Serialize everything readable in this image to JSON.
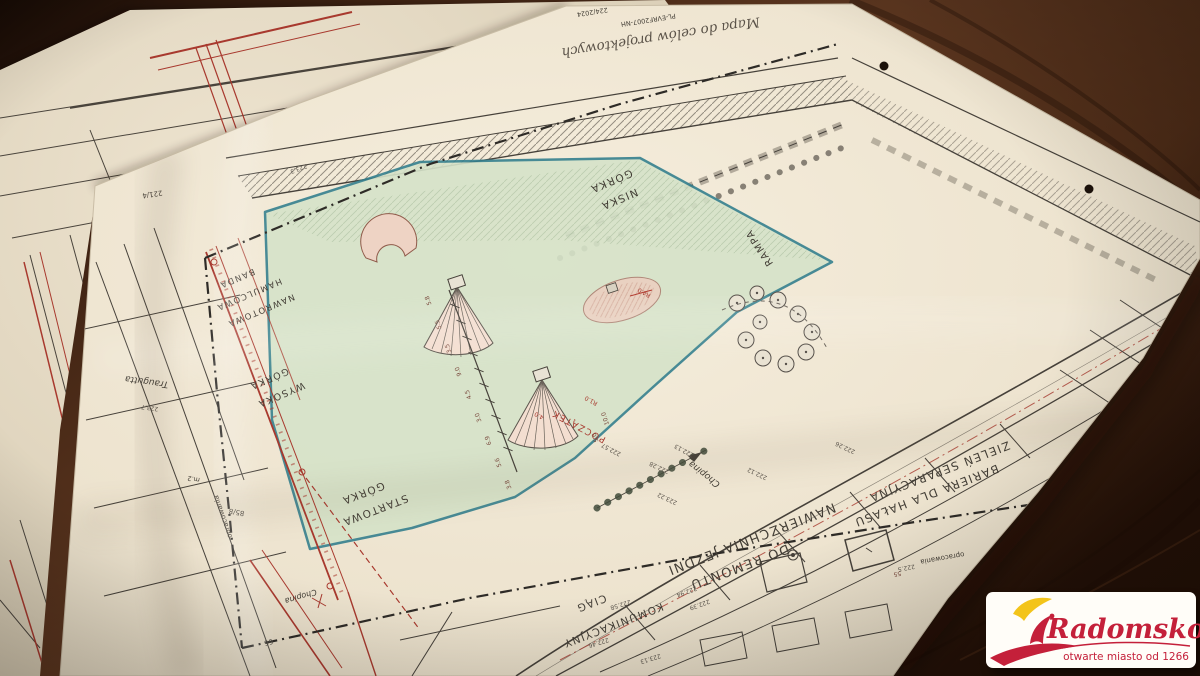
{
  "scene": {
    "description": "Photograph of technical site plans (Polish survey map for a bike/pumptrack project) lying on a dark wooden table, with the Radomsko city logo card in the bottom-right corner",
    "colors": {
      "wood": "#4e2d17",
      "paper": "#ece2cd",
      "ink": "#46413a",
      "red_lines": "#a8392e",
      "teal_outline": "#35808e",
      "site_green": "#d6e3c9",
      "ramp_pink": "#eccfc0"
    }
  },
  "plan": {
    "title": "Mapa do celów projektowych",
    "note": "PL-EVRF2007-NH",
    "reg_no": "224/2024",
    "features": {
      "gorka_niska": [
        "GÓRKA",
        "NISKA"
      ],
      "rampa": "RAMPA",
      "banda": [
        "BANDA",
        "HAMULCOWA",
        "NAWROTOWA"
      ],
      "gorka_wysoka": [
        "GÓRKA",
        "WYSOKA"
      ],
      "gorka_startowa": [
        "GÓRKA",
        "STARTOWA"
      ],
      "poczatek": "POCZĄTEK",
      "nawierzchnia": [
        "NAWIERZCHNIA JEZDNI",
        "DO REMONTU"
      ],
      "ciag": [
        "CIĄG",
        "KOMUNIKACYJNY"
      ],
      "zielen": [
        "ZIELEŃ SEPARACYJNA",
        "BARIERA DLA HAŁASU"
      ],
      "granica": "opracowania"
    },
    "streets": {
      "chopina": "Chopina",
      "traugutta": "Traugutta",
      "zwirki": "Żwirki"
    },
    "parcels": [
      "85/8",
      "221/4",
      "m.2",
      "66",
      "56.41"
    ],
    "elevations": [
      "222.57",
      "222.94",
      "222.39",
      "223.22",
      "222.12",
      "223.7",
      "223.11",
      "222.46",
      "222.58",
      "223.13",
      "222.5",
      "222.28",
      "222.13",
      "222.26",
      "223.3"
    ],
    "dims": [
      "5.8",
      "5.5",
      "3.5",
      "9.0",
      "4.5",
      "3.0",
      "6.9",
      "5.6",
      "3.8",
      "4.0",
      "10.0",
      "5.0",
      "R4.0",
      "R1.0",
      "55"
    ]
  },
  "logo": {
    "brand": "Radomsko",
    "tagline": "otwarte miasto od 1266",
    "red": "#c4203a",
    "yellow": "#f3c41a"
  }
}
